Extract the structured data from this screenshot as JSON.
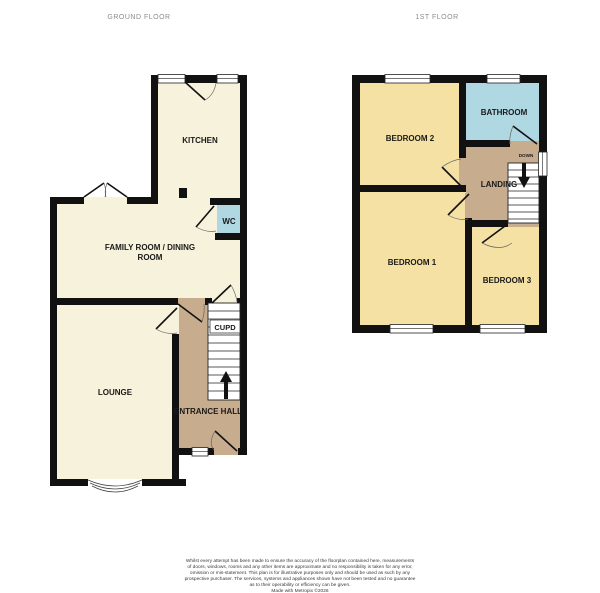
{
  "titles": {
    "ground_floor": "GROUND FLOOR",
    "first_floor": "1ST FLOOR"
  },
  "ground_floor": {
    "kitchen": "KITCHEN",
    "wc": "WC",
    "family_room_line1": "FAMILY ROOM / DINING",
    "family_room_line2": "ROOM",
    "lounge": "LOUNGE",
    "cupboard": "CUPD",
    "entrance_hall": "ENTRANCE HALL"
  },
  "first_floor": {
    "bedroom2": "BEDROOM 2",
    "bathroom": "BATHROOM",
    "landing": "LANDING",
    "down": "DOWN",
    "bedroom1": "BEDROOM 1",
    "bedroom3": "BEDROOM 3"
  },
  "colors": {
    "wall": "#111111",
    "room_cream": "#F7F2DC",
    "room_yellow": "#F5E1A4",
    "room_blue": "#AFD8E2",
    "hall_tan": "#C7AC8D",
    "arrow_black": "#111111"
  },
  "disclaimer": {
    "lines": [
      "Whilst every attempt has been made to ensure the accuracy of the floorplan contained here, measurements",
      "of doors, windows, rooms and any other items are approximate and no responsibility is taken for any error,",
      "omission or mis-statement. This plan is for illustrative purposes only and should be used as such by any",
      "prospective purchaser. The services, systems and appliances shown have not been tested and no guarantee",
      "as to their operability or efficiency can be given.",
      "Made with Metropix ©2026"
    ]
  }
}
